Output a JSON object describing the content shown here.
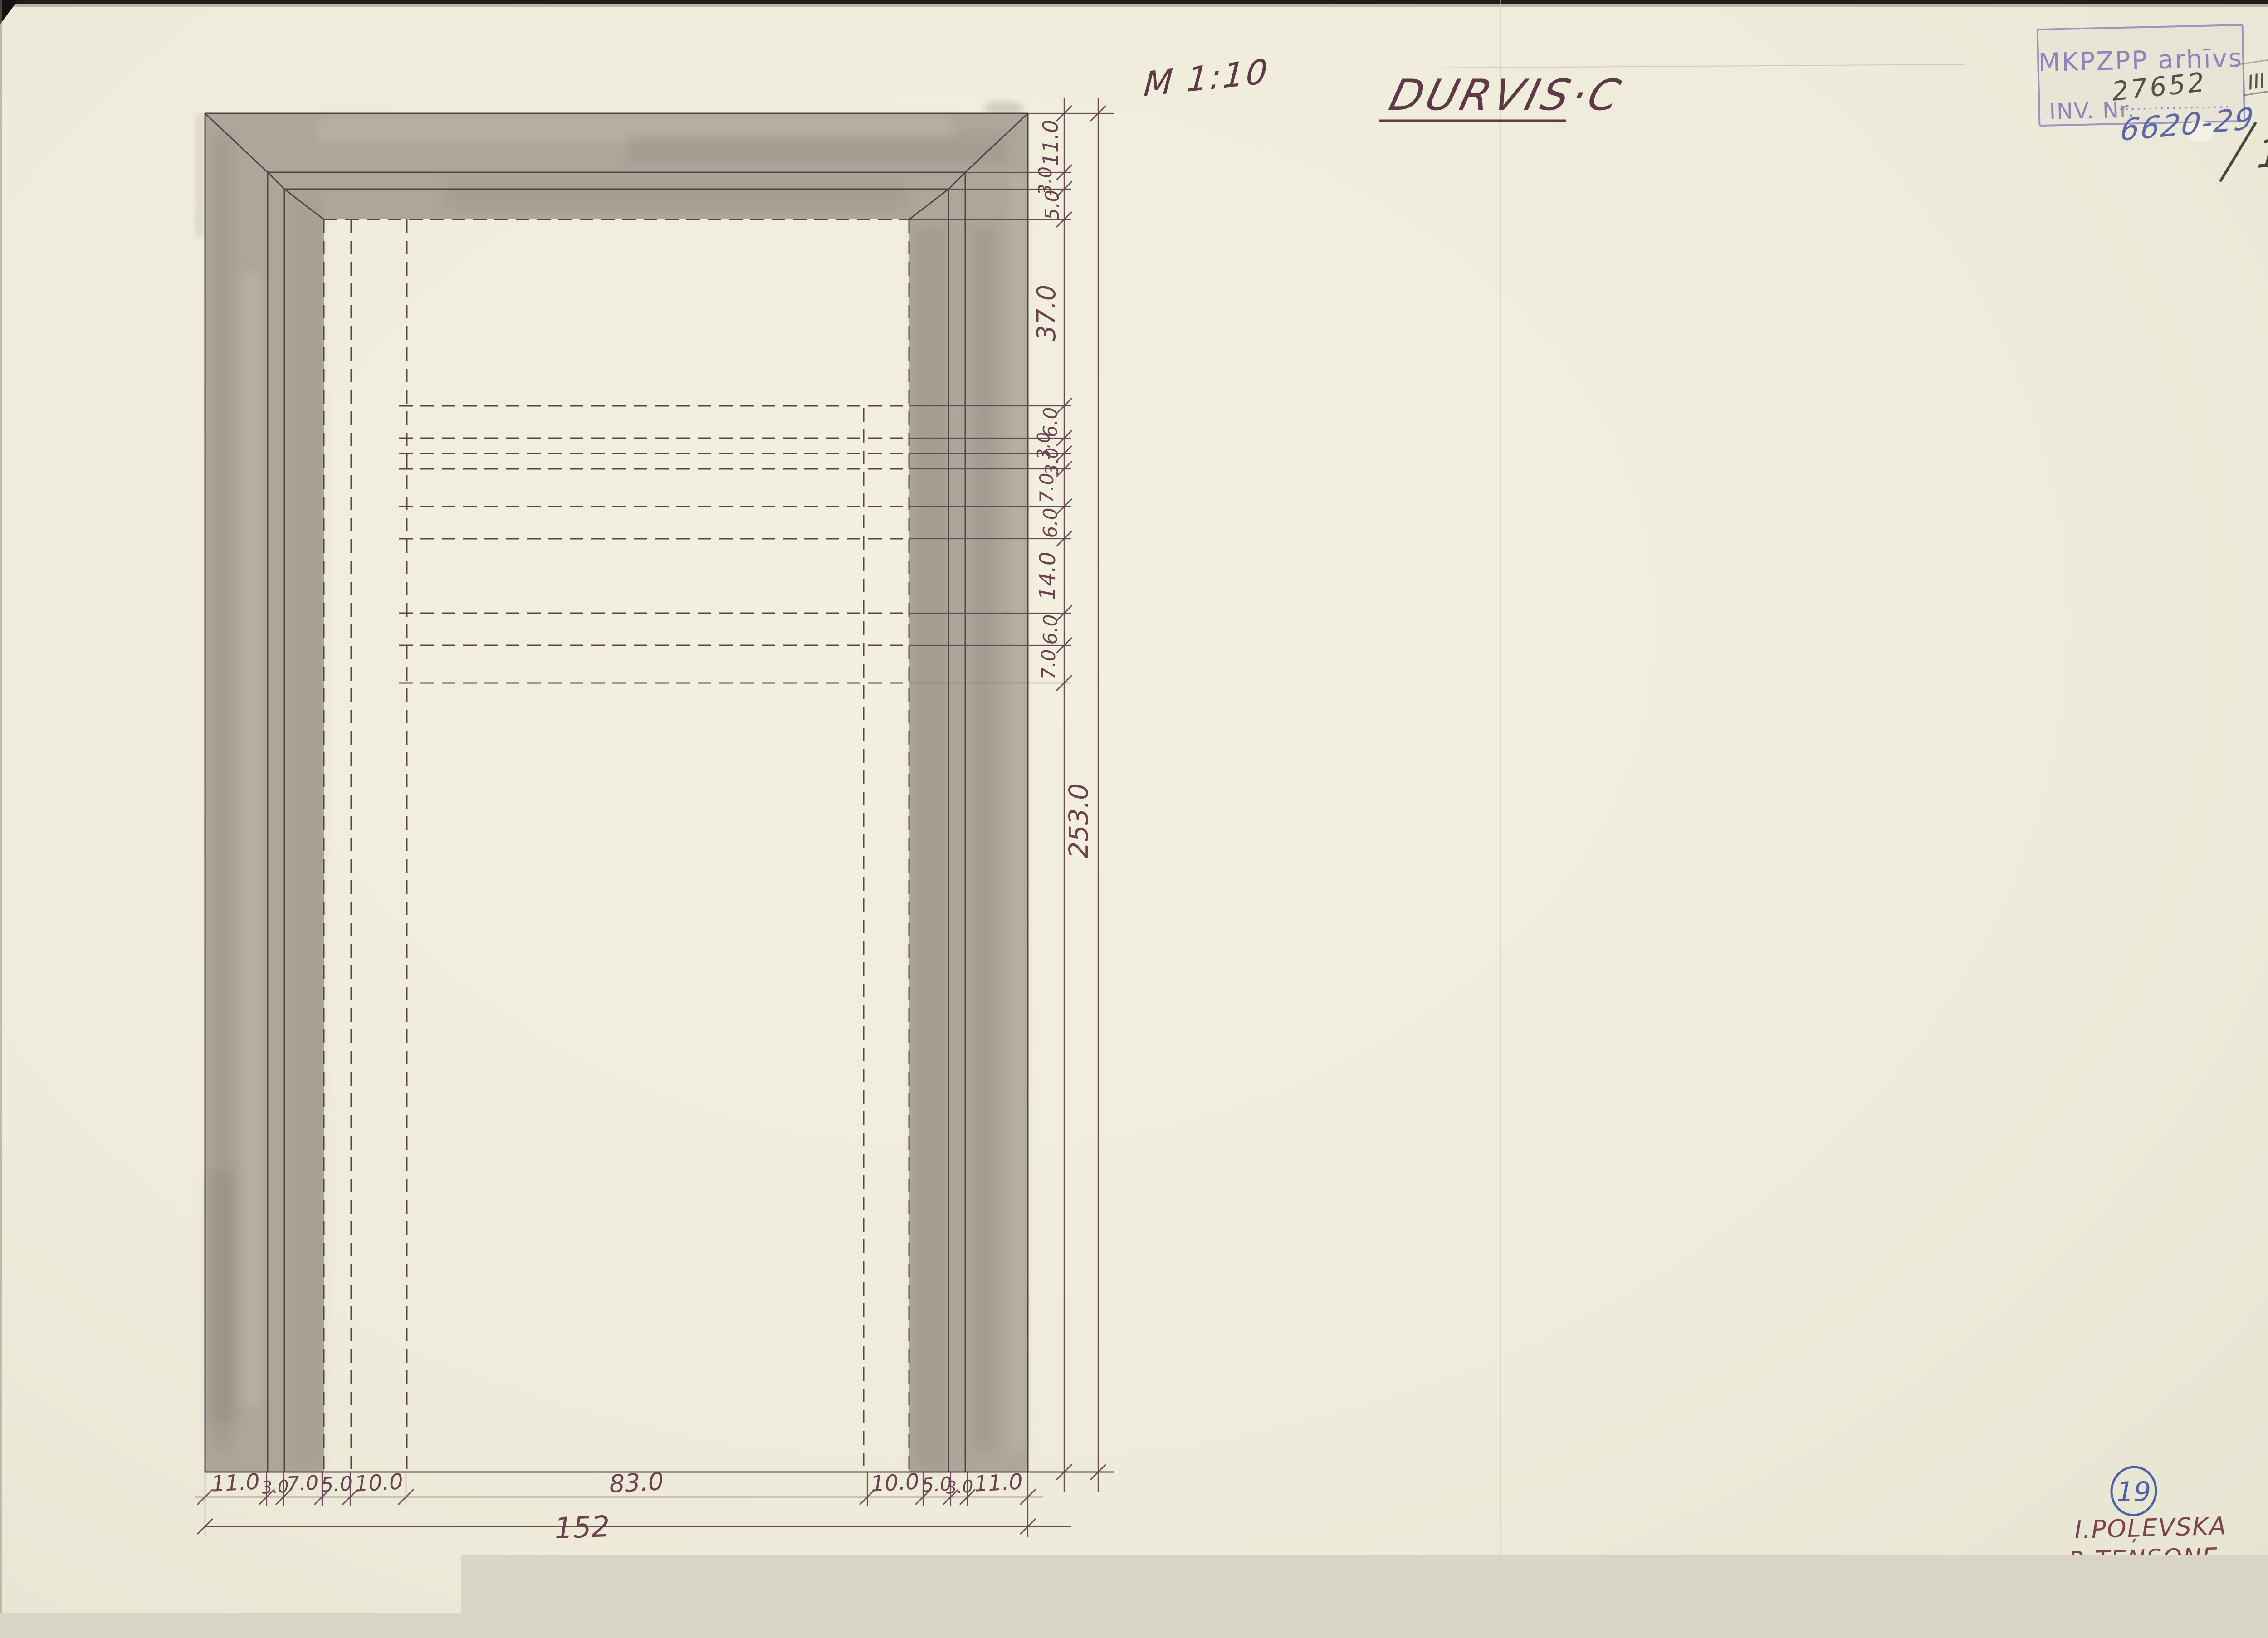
{
  "doc": {
    "scale_note": "M 1:10",
    "title": "DURVIS·C",
    "page_number": "11"
  },
  "stamp": {
    "org": "MKPZPP arhīvs",
    "inv_label": "INV. Nr.",
    "inv_number_pencil": "27652",
    "inv_number_pen": "6620-29",
    "roman_mark": "III"
  },
  "sheet": {
    "badge_number": "19",
    "authors": [
      "I.POĻEVSKA",
      "R.TENSONE",
      "A.ARTIŠEVSKIS"
    ],
    "year": "1986."
  },
  "dims": {
    "right": [
      "11.0",
      "3.0",
      "5.0",
      "37.0",
      "6.0",
      "3.0",
      "3.0",
      "7.0",
      "6.0",
      "14.0",
      "6.0",
      "7.0"
    ],
    "right_total": "253.0",
    "bottom": [
      "11.0",
      "3.0",
      "7.0",
      "5.0",
      "10.0",
      "83.0",
      "10.0",
      "5.0",
      "3.0",
      "11.0"
    ],
    "bottom_total": "152"
  },
  "drawing": {
    "object": "door elevation",
    "overall_width_label": "152",
    "overall_height_label": "253.0"
  },
  "colors": {
    "ink": "#564049",
    "dimension_text": "#6d4250",
    "wash_grey": "#ada79a",
    "stamp_violet": "#9184ba",
    "pen_blue": "#5b6aa4",
    "badge_blue": "#4d62a8",
    "paper": "#efecdb"
  }
}
